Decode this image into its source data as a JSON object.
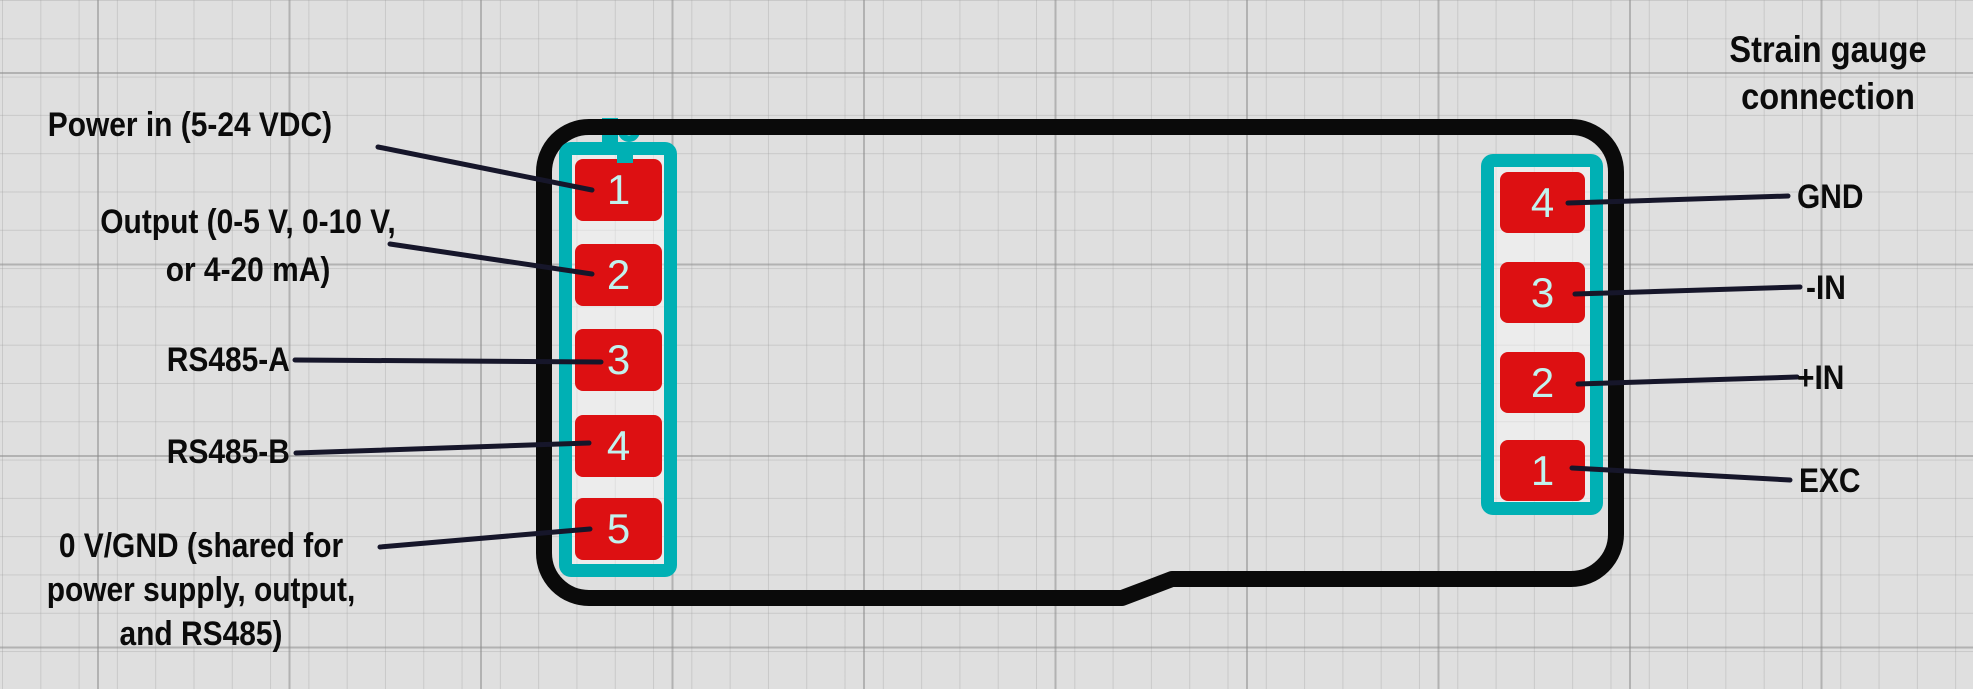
{
  "diagram": {
    "right_heading": "Strain gauge\nconnection",
    "left_labels": [
      {
        "text": "Power in (5-24 VDC)",
        "pin": "1"
      },
      {
        "text": "Output (0-5 V, 0-10 V,\nor 4-20 mA)",
        "pin": "2"
      },
      {
        "text": "RS485-A",
        "pin": "3"
      },
      {
        "text": "RS485-B",
        "pin": "4"
      },
      {
        "text": "0 V/GND (shared for\npower supply, output,\nand RS485)",
        "pin": "5"
      }
    ],
    "right_labels": [
      {
        "text": "GND",
        "pin": "4"
      },
      {
        "text": "-IN",
        "pin": "3"
      },
      {
        "text": "+IN",
        "pin": "2"
      },
      {
        "text": "EXC",
        "pin": "1"
      }
    ],
    "connectors": {
      "left": {
        "pins": [
          "1",
          "2",
          "3",
          "4",
          "5"
        ]
      },
      "right": {
        "pins": [
          "4",
          "3",
          "2",
          "1"
        ]
      }
    },
    "colors": {
      "background": "#dfdfdf",
      "device_outline": "#0a0a0a",
      "connector_frame": "#00b0b4",
      "pin_fill": "#dd1012",
      "pin_number": "#c2f2ee",
      "leader_line": "#16162a",
      "label_text": "#0b0b0b"
    }
  }
}
